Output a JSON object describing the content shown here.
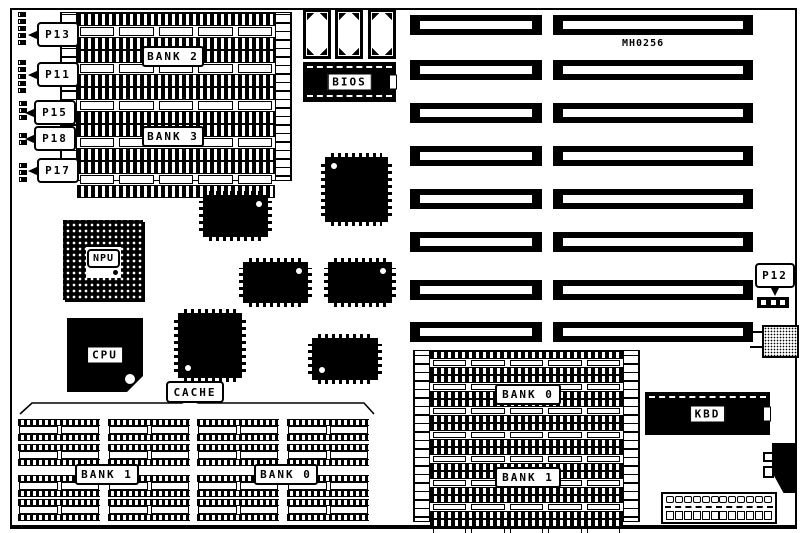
{
  "board": {
    "model_number": "MH0256",
    "foreground": "#000000",
    "background": "#ffffff"
  },
  "connector_labels": {
    "p13": "P13",
    "p11": "P11",
    "p15": "P15",
    "p18": "P18",
    "p17": "P17",
    "p12": "P12"
  },
  "chip_labels": {
    "bios": "BIOS",
    "npu": "NPU",
    "cpu": "CPU",
    "cache": "CACHE",
    "kbd": "KBD"
  },
  "memory_banks": {
    "simm_top_left": {
      "upper": "BANK 2",
      "lower": "BANK 3"
    },
    "dip_bottom_left": {
      "left": "BANK 1",
      "right": "BANK 0"
    },
    "simm_bottom_right": {
      "upper": "BANK 0",
      "lower": "BANK 1"
    }
  }
}
